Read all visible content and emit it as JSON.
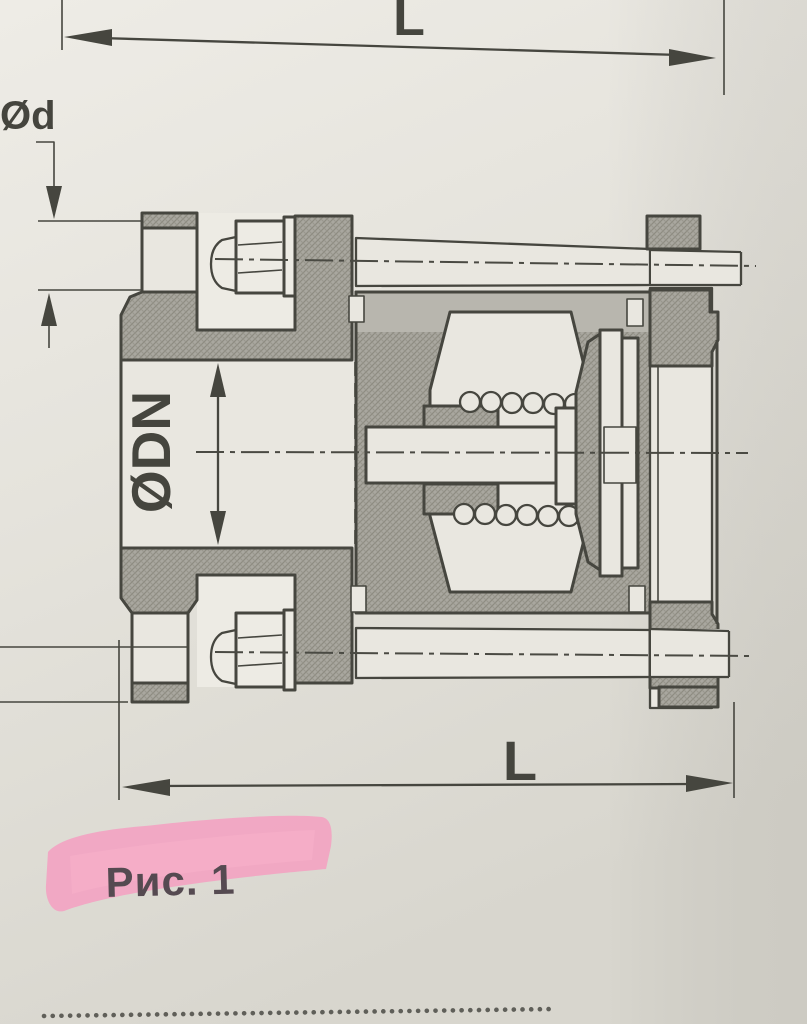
{
  "figure": {
    "caption": "Рис. 1",
    "dimension_labels": {
      "length_top": "L",
      "length_bottom": "L",
      "bolt_hole_diameter": "Ød",
      "nominal_bore_diameter": "ØDN"
    }
  },
  "colors": {
    "paper": "#e6e4dd",
    "paper_dark": "#d7d5cd",
    "drawing_line": "#46463f",
    "hatch_fill": "#a9a79f",
    "hatch_texture": "#8e8c82",
    "flat_gray": "#b8b6ae",
    "light_fill": "#e9e7e0",
    "highlight_pink": "#f5a0c0",
    "caption_text": "#554a51"
  }
}
